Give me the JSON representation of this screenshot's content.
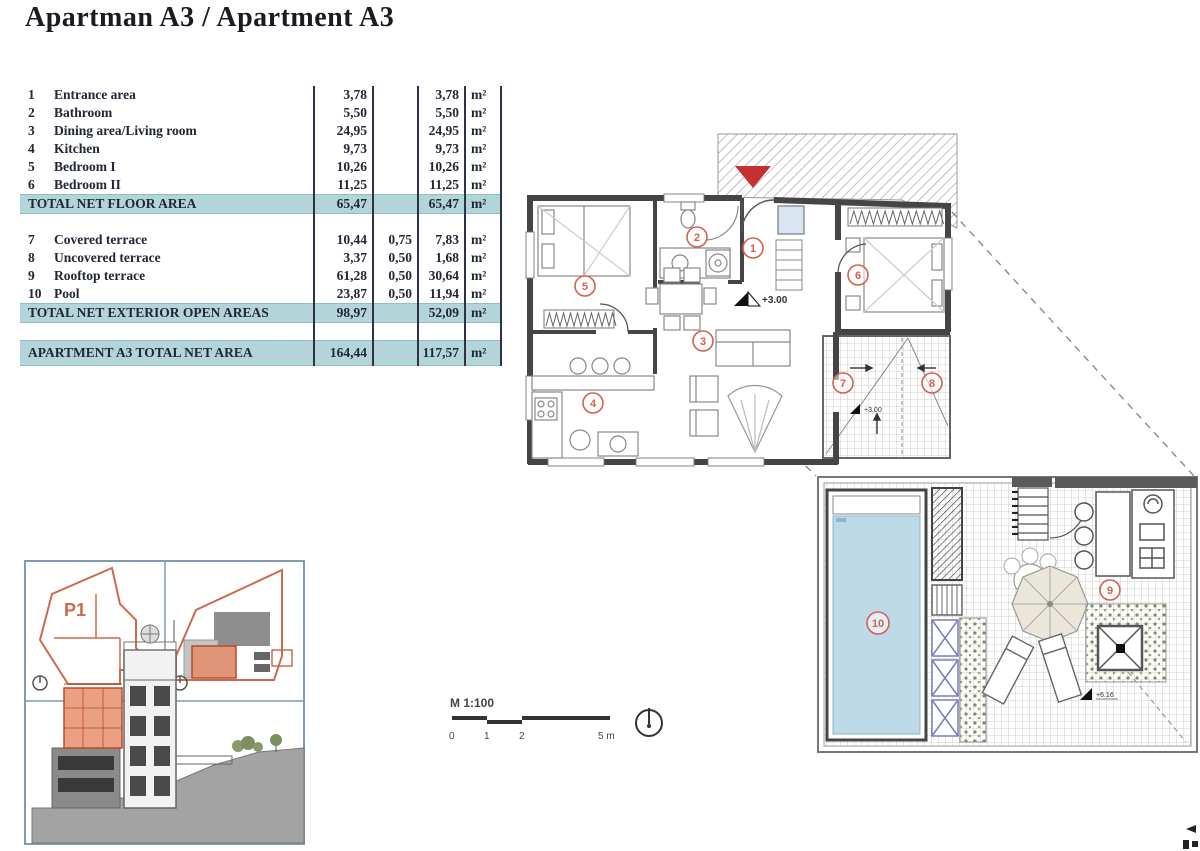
{
  "title": "Apartman A3 / Apartment A3",
  "table": {
    "unit": "m²",
    "rows": [
      {
        "num": "1",
        "label": "Entrance area",
        "area": "3,78",
        "coef": "",
        "net": "3,78"
      },
      {
        "num": "2",
        "label": "Bathroom",
        "area": "5,50",
        "coef": "",
        "net": "5,50"
      },
      {
        "num": "3",
        "label": "Dining area/Living room",
        "area": "24,95",
        "coef": "",
        "net": "24,95"
      },
      {
        "num": "4",
        "label": "Kitchen",
        "area": "9,73",
        "coef": "",
        "net": "9,73"
      },
      {
        "num": "5",
        "label": "Bedroom I",
        "area": "10,26",
        "coef": "",
        "net": "10,26"
      },
      {
        "num": "6",
        "label": "Bedroom II",
        "area": "11,25",
        "coef": "",
        "net": "11,25"
      }
    ],
    "floor_total": {
      "label": "TOTAL NET FLOOR AREA",
      "area": "65,47",
      "coef": "",
      "net": "65,47"
    },
    "exterior_rows": [
      {
        "num": "7",
        "label": "Covered terrace",
        "area": "10,44",
        "coef": "0,75",
        "net": "7,83"
      },
      {
        "num": "8",
        "label": "Uncovered terrace",
        "area": "3,37",
        "coef": "0,50",
        "net": "1,68"
      },
      {
        "num": "9",
        "label": "Rooftop terrace",
        "area": "61,28",
        "coef": "0,50",
        "net": "30,64"
      },
      {
        "num": "10",
        "label": "Pool",
        "area": "23,87",
        "coef": "0,50",
        "net": "11,94"
      }
    ],
    "exterior_total": {
      "label": "TOTAL NET EXTERIOR OPEN AREAS",
      "area": "98,97",
      "coef": "",
      "net": "52,09"
    },
    "grand_total": {
      "label": "APARTMENT A3 TOTAL NET AREA",
      "area": "164,44",
      "coef": "",
      "net": "117,57"
    }
  },
  "plan": {
    "rooms": [
      "1",
      "2",
      "3",
      "4",
      "5",
      "6",
      "7",
      "8",
      "9",
      "10"
    ],
    "levels": [
      "+3.00",
      "+3.00",
      "+6.16"
    ],
    "inset_parcel_label": "P1"
  },
  "scale": {
    "label": "M 1:100",
    "ticks": [
      "0",
      "1",
      "2",
      "5 m"
    ]
  },
  "colors": {
    "highlight": "#b3d4d9",
    "accent_red": "#d4604e",
    "entrance_arrow_red": "#c53030",
    "pool_blue": "#bedae9",
    "inset_orange": "#cd6a4c",
    "wall_grey": "#454545"
  }
}
